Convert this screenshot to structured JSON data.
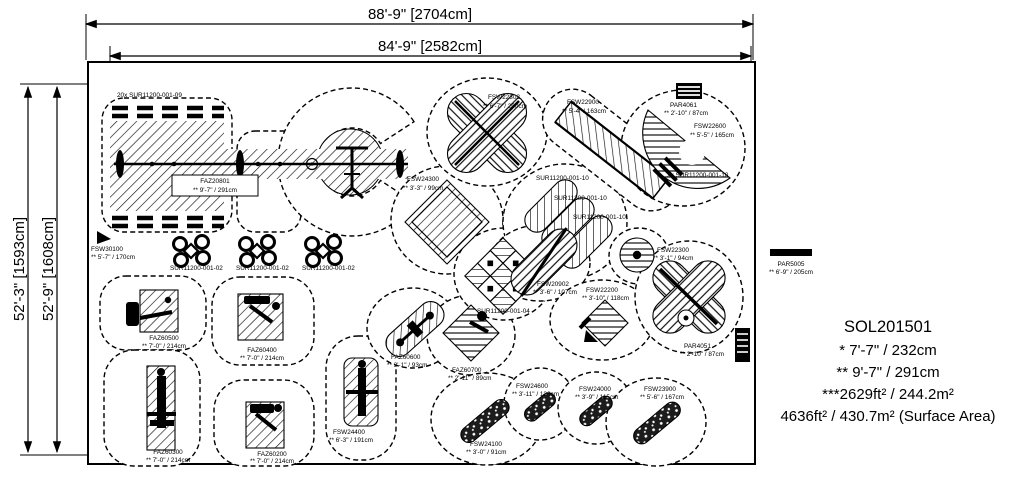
{
  "dimensions": {
    "top_outer": "88'-9\" [2704cm]",
    "top_inner": "84'-9\" [2582cm]",
    "left_outer": "52'-3\" [1593cm]",
    "left_inner": "52'-9\" [1608cm]"
  },
  "summary": {
    "model": "SOL201501",
    "note1": "* 7'-7\" / 232cm",
    "note2": "** 9'-7\" / 291cm",
    "note3": "***2629ft² / 244.2m²",
    "note4": "4636ft² / 430.7m² (Surface Area)"
  },
  "labels": {
    "sur09": {
      "text": "20x SUR11200-001-09"
    },
    "faz20801": {
      "code": "FAZ20801",
      "size": "** 9'-7\" / 291cm"
    },
    "fsw30100": {
      "code": "FSW30100",
      "size": "** 5'-7\" / 170cm"
    },
    "sur02a": {
      "text": "SUR11200-001-02"
    },
    "sur02b": {
      "text": "SUR11200-001-02"
    },
    "sur02c": {
      "text": "SUR11200-001-02"
    },
    "fsw22302": {
      "code": "FSW22302",
      "size": "** 6'-7\" / 200cm"
    },
    "fsw22900": {
      "code": "FSW22900",
      "size": "** 5'-4\" / 163cm"
    },
    "par4061": {
      "code": "PAR4061",
      "size": "** 2'-10\" / 87cm"
    },
    "fsw22600": {
      "code": "FSW22600",
      "size": "** 5'-5\" / 165cm"
    },
    "fsw24300": {
      "code": "FSW24300",
      "size": "** 3'-3\" / 99cm"
    },
    "sur10a": {
      "text": "SUR11200-001-10"
    },
    "sur10b": {
      "text": "SUR11200-001-10"
    },
    "sur10c": {
      "text": "SUR11200-001-10"
    },
    "sur10x2": {
      "text": "2x SUR11200-001-10"
    },
    "sur04": {
      "text": "SUR11200-001-04"
    },
    "fsw20902": {
      "code": "FSW20902",
      "size": "** 3'-6\" / 107cm"
    },
    "fsw22200": {
      "code": "FSW22200",
      "size": "** 3'-10\" / 118cm"
    },
    "fsw22300": {
      "code": "FSW22300",
      "size": "** 3'-1\" / 94cm"
    },
    "faz60600": {
      "code": "FAZ60600",
      "size": "** 3'-1\" / 93cm"
    },
    "faz60700": {
      "code": "FAZ60700",
      "size": "** 2'-11\" / 89cm"
    },
    "fsw24400": {
      "code": "FSW24400",
      "size": "** 6'-3\" / 191cm"
    },
    "fsw24600": {
      "code": "FSW24600",
      "size": "** 3'-11\" / 120cm"
    },
    "fsw24000": {
      "code": "FSW24000",
      "size": "** 3'-9\" / 115cm"
    },
    "fsw23900": {
      "code": "FSW23900",
      "size": "** 5'-6\" / 167cm"
    },
    "fsw24100": {
      "code": "FSW24100",
      "size": "** 3'-0\" / 91cm"
    },
    "faz60500": {
      "code": "FAZ60500",
      "size": "** 7'-0\" / 214cm"
    },
    "faz60400": {
      "code": "FAZ60400",
      "size": "** 7'-0\" / 214cm"
    },
    "faz60300": {
      "code": "FAZ60300",
      "size": "** 7'-0\" / 214cm"
    },
    "faz60200": {
      "code": "FAZ60200",
      "size": "** 7'-0\" / 214cm"
    },
    "par4051": {
      "code": "PAR4051",
      "size": "** 2'-10\" / 87cm"
    },
    "par5005": {
      "code": "PAR5005",
      "size": "** 6'-9\" / 205cm"
    }
  }
}
